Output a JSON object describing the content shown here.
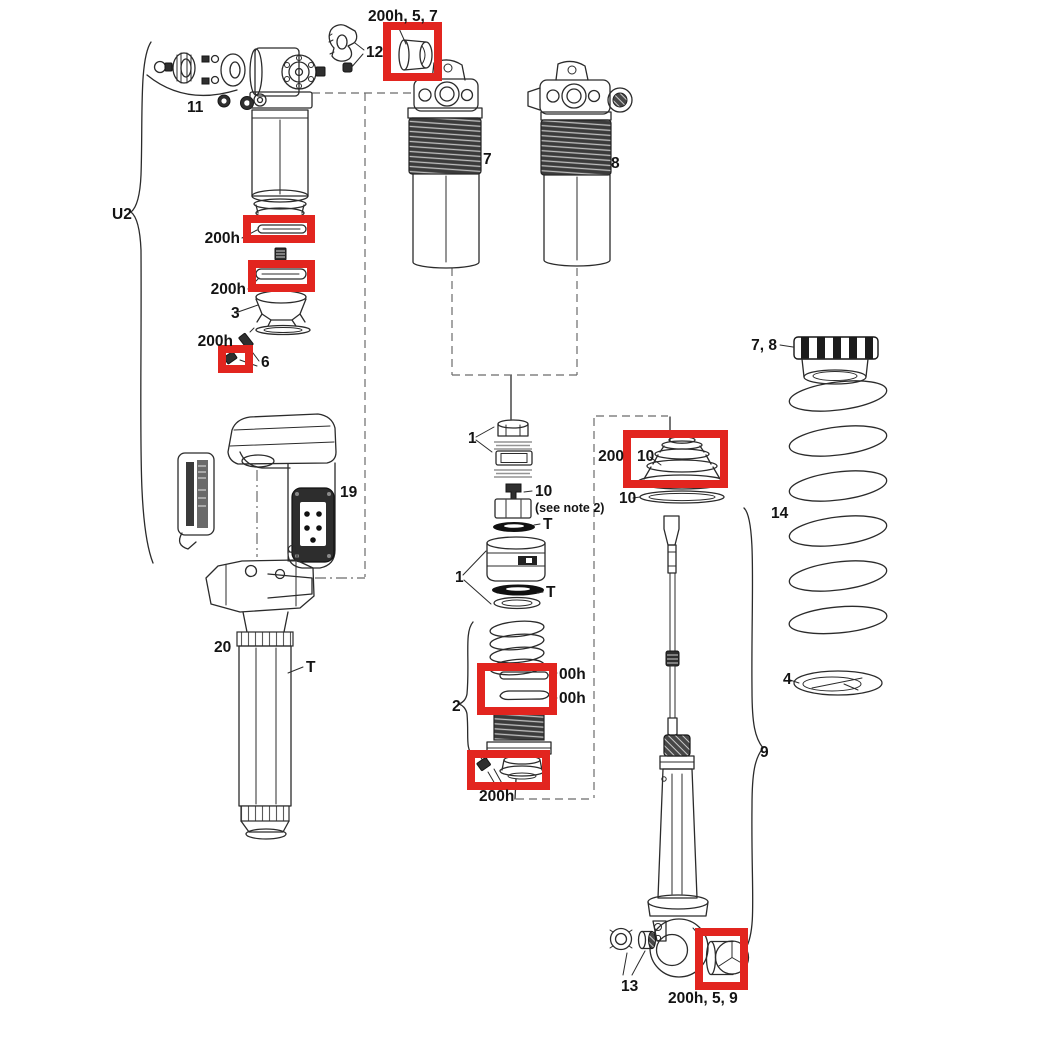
{
  "diagram": {
    "kind": "exploded-parts-diagram",
    "colors": {
      "highlight": "#e2251f",
      "line": "#2b2b2b"
    },
    "labels": {
      "top_bushing": "200h, 5, 7",
      "lever_12": "12",
      "kit_11": "11",
      "u2": "U2",
      "seal_upper": "200h",
      "seal_lower": "200h",
      "piston_3": "3",
      "fitting_200h": "200h",
      "bolt_6": "6",
      "body_7": "7",
      "body_8": "8",
      "collar_78": "7, 8",
      "spring_14": "14",
      "retainer_4": "4",
      "stack_upper_1": "1",
      "valve_10": "10",
      "valve_note": "(see note 2)",
      "t_upper": "T",
      "stack_lower_1": "1",
      "t_lower": "T",
      "group_2": "2",
      "ring_upper": "00h",
      "ring_lower": "00h",
      "cap_200h": "200h",
      "bellows_200": "200",
      "bellows_10": "10",
      "washer_10": "10",
      "shaft_9": "9",
      "hw_13": "13",
      "bushing_200h59": "200h, 5, 9",
      "module_19": "19",
      "body_20": "20",
      "tube_t": "T"
    }
  }
}
